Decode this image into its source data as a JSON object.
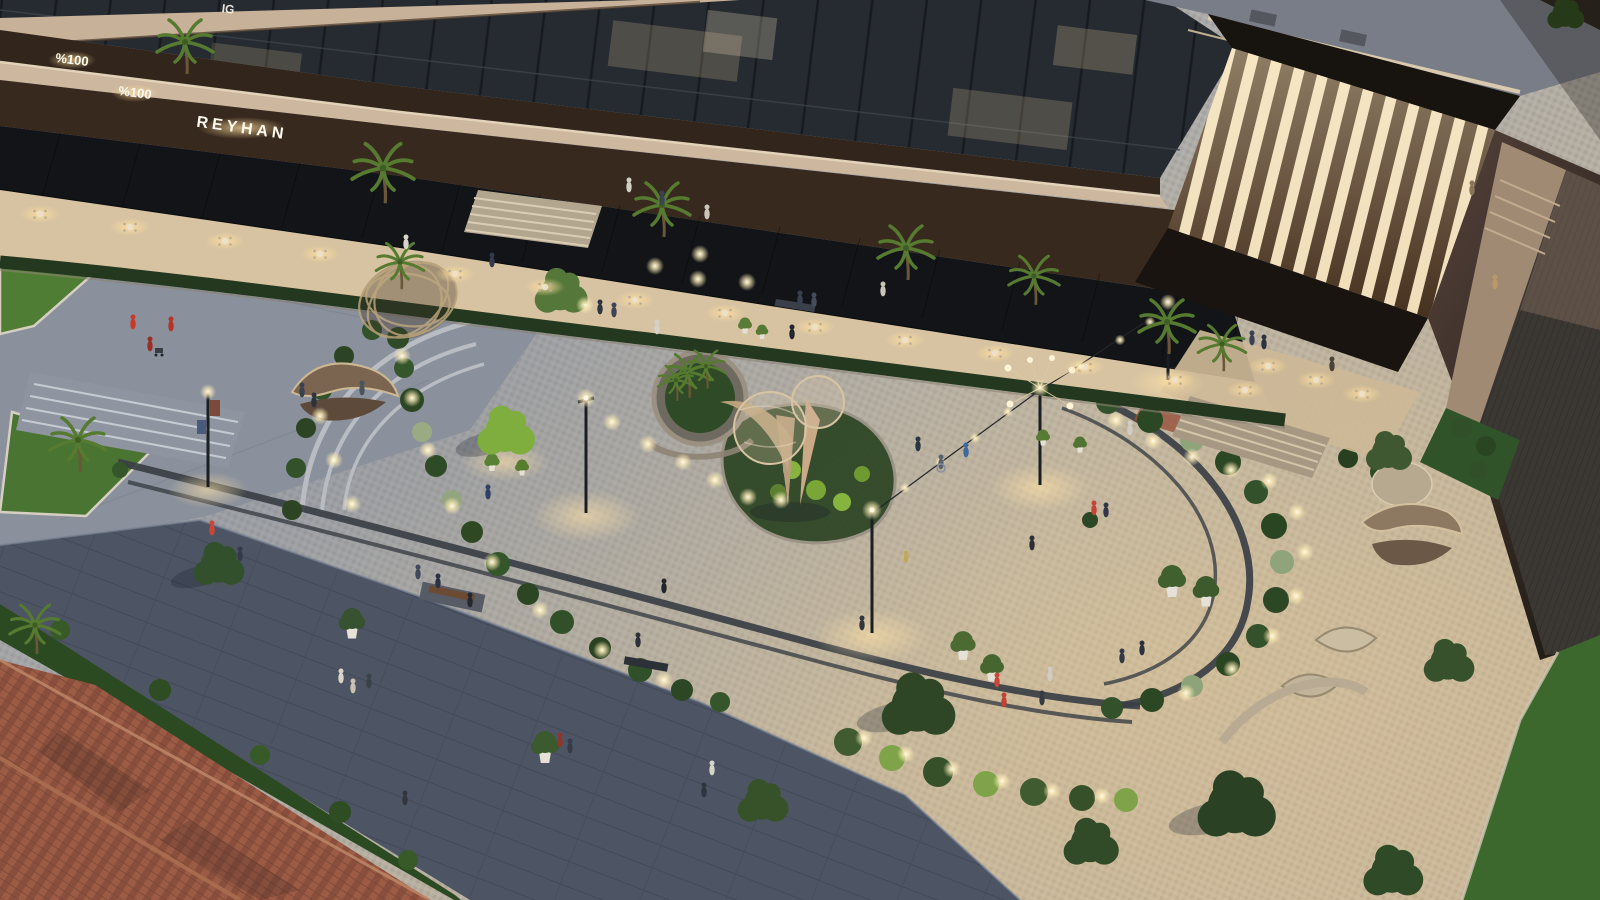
{
  "image": {
    "alt": "Dusk aerial rendering of a landscaped pocket-park plaza with curved paths, sculptures and string lights beside a mixed-use building with restaurant terraces, a clay tile roof in the lower left corner",
    "width_px": 1600,
    "height_px": 900
  },
  "signs": {
    "sign_top_partial": "IG",
    "sign_percent_upper": "%100",
    "sign_percent_lower": "%100",
    "sign_restaurant": "REYHAN"
  },
  "palette": {
    "facade_cream": "#cdb79e",
    "glass_dark": "#262b31",
    "wood_fascia": "#38291e",
    "canopy_black": "#121417",
    "terrace_warm": "#d7c3a2",
    "plaza_cool": "#a3a8b1",
    "plaza_warm": "#c3b29a",
    "promenade_pavers": "#4d5565",
    "roof_tiles": "#9c5c45",
    "grass_dark": "#2c4a22",
    "tree_green": "#3d5530",
    "tree_lit": "#7fae3e",
    "light_warm": "#ffe9bd",
    "louver_lit": "#f0debb"
  },
  "scatter": {
    "bushes": {
      "symbol": "#sym-bush",
      "name": "shrub",
      "items": [
        [
          398,
          338,
          1.1,
          "#2f4a26"
        ],
        [
          404,
          368,
          1.0,
          "#35552b"
        ],
        [
          412,
          400,
          1.2,
          "#2c4523"
        ],
        [
          422,
          432,
          1.0,
          "#9aab84"
        ],
        [
          436,
          466,
          1.1,
          "#2f4a26"
        ],
        [
          452,
          500,
          1.0,
          "#93a57e"
        ],
        [
          472,
          532,
          1.1,
          "#2e4824"
        ],
        [
          498,
          564,
          1.2,
          "#35552b"
        ],
        [
          528,
          594,
          1.1,
          "#2c4523"
        ],
        [
          562,
          622,
          1.2,
          "#31502a"
        ],
        [
          600,
          648,
          1.1,
          "#2a4221"
        ],
        [
          640,
          670,
          1.2,
          "#31502a"
        ],
        [
          682,
          690,
          1.1,
          "#2c4724"
        ],
        [
          720,
          702,
          1.0,
          "#35552b"
        ],
        [
          292,
          510,
          1.0,
          "#2c4423"
        ],
        [
          296,
          468,
          1.0,
          "#33512a"
        ],
        [
          306,
          428,
          1.0,
          "#2c4423"
        ],
        [
          322,
          390,
          1.0,
          "#33512a"
        ],
        [
          344,
          356,
          1.0,
          "#2c4423"
        ],
        [
          372,
          330,
          1.0,
          "#33512a"
        ],
        [
          1108,
          402,
          1.2,
          "#33512a"
        ],
        [
          1150,
          420,
          1.3,
          "#2c4723"
        ],
        [
          1192,
          440,
          1.2,
          "#90a47c"
        ],
        [
          1228,
          462,
          1.3,
          "#2c4723"
        ],
        [
          1256,
          492,
          1.2,
          "#33512a"
        ],
        [
          1274,
          526,
          1.3,
          "#2a4522"
        ],
        [
          1282,
          562,
          1.2,
          "#90a47c"
        ],
        [
          1276,
          600,
          1.3,
          "#2c4723"
        ],
        [
          1258,
          636,
          1.2,
          "#33512a"
        ],
        [
          1228,
          664,
          1.2,
          "#2a4522"
        ],
        [
          1192,
          686,
          1.1,
          "#8fa37b"
        ],
        [
          1152,
          700,
          1.2,
          "#2c4723"
        ],
        [
          1112,
          708,
          1.1,
          "#33512a"
        ],
        [
          848,
          742,
          1.4,
          "#3f5b2f"
        ],
        [
          892,
          758,
          1.3,
          "#7fa348"
        ],
        [
          938,
          772,
          1.5,
          "#36512a"
        ],
        [
          986,
          784,
          1.3,
          "#7fa348"
        ],
        [
          1034,
          792,
          1.4,
          "#3f5b2f"
        ],
        [
          1082,
          798,
          1.3,
          "#36512a"
        ],
        [
          1126,
          800,
          1.2,
          "#7fa348"
        ],
        [
          792,
          470,
          0.9,
          "#86b43f"
        ],
        [
          816,
          490,
          1.0,
          "#79a637"
        ],
        [
          842,
          502,
          0.9,
          "#86b43f"
        ],
        [
          862,
          474,
          0.8,
          "#6f9a32"
        ],
        [
          778,
          492,
          0.8,
          "#5d8030"
        ],
        [
          628,
          252,
          1.0,
          "#31502a"
        ],
        [
          648,
          258,
          0.9,
          "#3a5c2f"
        ],
        [
          742,
          268,
          1.0,
          "#31502a"
        ],
        [
          764,
          274,
          0.9,
          "#3a5c2f"
        ],
        [
          860,
          284,
          1.0,
          "#31502a"
        ],
        [
          884,
          290,
          0.9,
          "#3a5c2f"
        ],
        [
          700,
          243,
          0.8,
          "#31502a"
        ],
        [
          1462,
          428,
          1.0,
          "#31502a"
        ],
        [
          1486,
          446,
          1.0,
          "#2a4522"
        ],
        [
          1478,
          470,
          0.9,
          "#31502a"
        ],
        [
          60,
          630,
          1.0,
          "#375a28"
        ],
        [
          160,
          690,
          1.1,
          "#2e4d22"
        ],
        [
          260,
          755,
          1.0,
          "#375a28"
        ],
        [
          340,
          812,
          1.1,
          "#2e4d22"
        ],
        [
          408,
          860,
          1.0,
          "#375a28"
        ],
        [
          1316,
          444,
          1.0,
          "#2f4c26"
        ],
        [
          1348,
          458,
          1.0,
          "#284020"
        ],
        [
          1380,
          472,
          1.0,
          "#2f4c26"
        ],
        [
          1408,
          488,
          0.9,
          "#284020"
        ],
        [
          992,
          62,
          0.7,
          "#3f5d2c"
        ],
        [
          1034,
          72,
          0.6,
          "#466430"
        ],
        [
          1120,
          90,
          0.6,
          "#3f5d2c"
        ],
        [
          120,
          470,
          0.8,
          "#35552b"
        ],
        [
          1090,
          520,
          0.8,
          "#2c4723"
        ]
      ]
    },
    "pot_trees": {
      "symbol": "#sym-pottree",
      "name": "potted-tree",
      "items": [
        [
          963,
          650,
          0.9,
          "#4c6b33"
        ],
        [
          992,
          672,
          0.85,
          "#47652f"
        ],
        [
          1172,
          586,
          1.0,
          "#40602e"
        ],
        [
          1206,
          596,
          0.95,
          "#3c5a2b"
        ],
        [
          352,
          628,
          0.95,
          "#375231"
        ],
        [
          545,
          752,
          1.0,
          "#3b5a2e"
        ],
        [
          492,
          465,
          0.55,
          "#5a8034"
        ],
        [
          522,
          470,
          0.5,
          "#567c30"
        ],
        [
          745,
          328,
          0.5,
          "#5a7c36"
        ],
        [
          762,
          334,
          0.45,
          "#557832"
        ],
        [
          1043,
          440,
          0.5,
          "#587a34"
        ],
        [
          1080,
          447,
          0.5,
          "#527433"
        ]
      ]
    },
    "trees": {
      "symbol": "#sym-tree",
      "name": "tree",
      "items": [
        [
          505,
          432,
          1.25,
          "#7fae3e"
        ],
        [
          560,
          292,
          1.15,
          "#55783a"
        ],
        [
          218,
          565,
          1.1,
          "#33502c"
        ],
        [
          762,
          802,
          1.1,
          "#375229"
        ],
        [
          917,
          706,
          1.6,
          "#2e4526"
        ],
        [
          1090,
          843,
          1.2,
          "#314b28"
        ],
        [
          1235,
          806,
          1.7,
          "#2b4123"
        ],
        [
          1392,
          872,
          1.3,
          "#2e4a26"
        ],
        [
          1448,
          662,
          1.1,
          "#36512c"
        ],
        [
          1388,
          452,
          1.0,
          "#3f5831"
        ],
        [
          1565,
          14,
          0.8,
          "#2e4d20"
        ]
      ]
    },
    "palms": {
      "symbol": "#sym-palm",
      "name": "palm-tree",
      "items": [
        [
          383,
          168,
          1.1
        ],
        [
          662,
          205,
          1.0
        ],
        [
          906,
          248,
          1.0
        ],
        [
          1034,
          276,
          0.9
        ],
        [
          1167,
          322,
          1.0
        ],
        [
          1222,
          344,
          0.85
        ],
        [
          78,
          440,
          1.0
        ],
        [
          35,
          625,
          0.9
        ],
        [
          185,
          42,
          1.0
        ],
        [
          688,
          372,
          0.8
        ],
        [
          706,
          366,
          0.7
        ],
        [
          676,
          380,
          0.65
        ],
        [
          400,
          262,
          0.85
        ]
      ]
    },
    "table_glows": {
      "symbol": "#sym-table",
      "name": "dining-table",
      "items": [
        [
          40,
          214
        ],
        [
          130,
          227
        ],
        [
          225,
          241
        ],
        [
          320,
          254
        ],
        [
          455,
          274
        ],
        [
          545,
          287
        ],
        [
          635,
          300
        ],
        [
          725,
          313
        ],
        [
          815,
          327
        ],
        [
          905,
          340
        ],
        [
          995,
          353
        ],
        [
          1085,
          367
        ],
        [
          1175,
          380
        ],
        [
          1245,
          390
        ],
        [
          1268,
          366
        ],
        [
          1316,
          380
        ],
        [
          1362,
          394
        ]
      ]
    },
    "ground_lights": {
      "symbol": "#sym-dot",
      "name": "ground-light",
      "items": [
        [
          402,
          356
        ],
        [
          412,
          398
        ],
        [
          428,
          450
        ],
        [
          452,
          506
        ],
        [
          492,
          562
        ],
        [
          540,
          610
        ],
        [
          602,
          650
        ],
        [
          664,
          680
        ],
        [
          612,
          422
        ],
        [
          648,
          444
        ],
        [
          683,
          462
        ],
        [
          715,
          480
        ],
        [
          748,
          497
        ],
        [
          781,
          500
        ],
        [
          1116,
          420
        ],
        [
          1153,
          441
        ],
        [
          1192,
          457
        ],
        [
          1231,
          470
        ],
        [
          1269,
          481
        ],
        [
          1297,
          512
        ],
        [
          1305,
          552
        ],
        [
          1296,
          596
        ],
        [
          1272,
          636
        ],
        [
          1232,
          669
        ],
        [
          1186,
          693
        ],
        [
          864,
          738
        ],
        [
          906,
          754
        ],
        [
          952,
          769
        ],
        [
          1002,
          781
        ],
        [
          1052,
          791
        ],
        [
          1102,
          796
        ],
        [
          585,
          305
        ],
        [
          655,
          266
        ],
        [
          698,
          279
        ],
        [
          747,
          282
        ],
        [
          700,
          254
        ],
        [
          320,
          416
        ],
        [
          334,
          460
        ],
        [
          352,
          504
        ],
        [
          905,
          488,
          0.6
        ],
        [
          940,
          462,
          0.6
        ],
        [
          975,
          438,
          0.6
        ],
        [
          1008,
          412,
          0.6
        ],
        [
          1080,
          366,
          0.6
        ],
        [
          1120,
          340,
          0.6
        ],
        [
          1150,
          322,
          0.6
        ]
      ]
    },
    "people": {
      "symbol": "#sym-person",
      "name": "person",
      "items": [
        [
          133,
          330,
          1,
          "#c8392b"
        ],
        [
          171,
          332,
          1,
          "#b23527"
        ],
        [
          150,
          352,
          1,
          "#993026"
        ],
        [
          302,
          398,
          1,
          "#39404e"
        ],
        [
          314,
          408,
          1,
          "#2c323e"
        ],
        [
          362,
          396,
          1,
          "#49525f"
        ],
        [
          406,
          250,
          1,
          "#d9d4c9"
        ],
        [
          492,
          268,
          1,
          "#333a4c"
        ],
        [
          629,
          193,
          1,
          "#d2cec3"
        ],
        [
          662,
          206,
          1,
          "#3b4252"
        ],
        [
          707,
          220,
          1,
          "#cbc6bb"
        ],
        [
          600,
          315,
          1,
          "#2e3440"
        ],
        [
          614,
          318,
          1,
          "#3e4554"
        ],
        [
          657,
          335,
          1,
          "#d6d0c5"
        ],
        [
          800,
          306,
          1,
          "#39414f"
        ],
        [
          814,
          308,
          1,
          "#454d5d"
        ],
        [
          792,
          340,
          1,
          "#22252d"
        ],
        [
          883,
          297,
          1,
          "#cac4b8"
        ],
        [
          918,
          452,
          1,
          "#2d3541"
        ],
        [
          941,
          470,
          1,
          "#59616f"
        ],
        [
          966,
          458,
          1,
          "#3f6aa0"
        ],
        [
          1094,
          516,
          1,
          "#c4443a"
        ],
        [
          1106,
          518,
          1,
          "#313748"
        ],
        [
          1130,
          436,
          1,
          "#d1ccc4"
        ],
        [
          906,
          563,
          0.8,
          "#c2a94e"
        ],
        [
          1252,
          346,
          1,
          "#3a4150"
        ],
        [
          1264,
          350,
          1,
          "#2c323e"
        ],
        [
          1332,
          372,
          1,
          "#4a4438"
        ],
        [
          1495,
          290,
          1,
          "#b89a6a"
        ],
        [
          1472,
          196,
          1,
          "#8a7458"
        ],
        [
          488,
          500,
          1,
          "#2f3f68"
        ],
        [
          418,
          580,
          1,
          "#40485a"
        ],
        [
          438,
          589,
          1,
          "#2b3240"
        ],
        [
          470,
          608,
          1,
          "#232830"
        ],
        [
          664,
          594,
          1,
          "#23262c"
        ],
        [
          638,
          648,
          1,
          "#2b303a"
        ],
        [
          712,
          776,
          1,
          "#d9d4c9"
        ],
        [
          704,
          798,
          1,
          "#2f343f"
        ],
        [
          560,
          748,
          1,
          "#8e352c"
        ],
        [
          570,
          754,
          1,
          "#363c48"
        ],
        [
          405,
          806,
          1,
          "#33363f"
        ],
        [
          341,
          684,
          1,
          "#dad3c6"
        ],
        [
          353,
          694,
          1,
          "#cac1b2"
        ],
        [
          369,
          689,
          1,
          "#3b4149"
        ],
        [
          1032,
          551,
          1,
          "#2b2f36"
        ],
        [
          1050,
          682,
          1,
          "#d1cbc1"
        ],
        [
          1042,
          706,
          1,
          "#353b45"
        ],
        [
          997,
          688,
          1,
          "#c64839"
        ],
        [
          1004,
          708,
          1,
          "#c14335"
        ],
        [
          1122,
          664,
          1,
          "#333947"
        ],
        [
          1142,
          656,
          1,
          "#2b313d"
        ],
        [
          862,
          631,
          1,
          "#32373f"
        ],
        [
          212,
          536,
          1,
          "#cc4636"
        ],
        [
          240,
          562,
          1,
          "#343a4c"
        ]
      ]
    }
  }
}
